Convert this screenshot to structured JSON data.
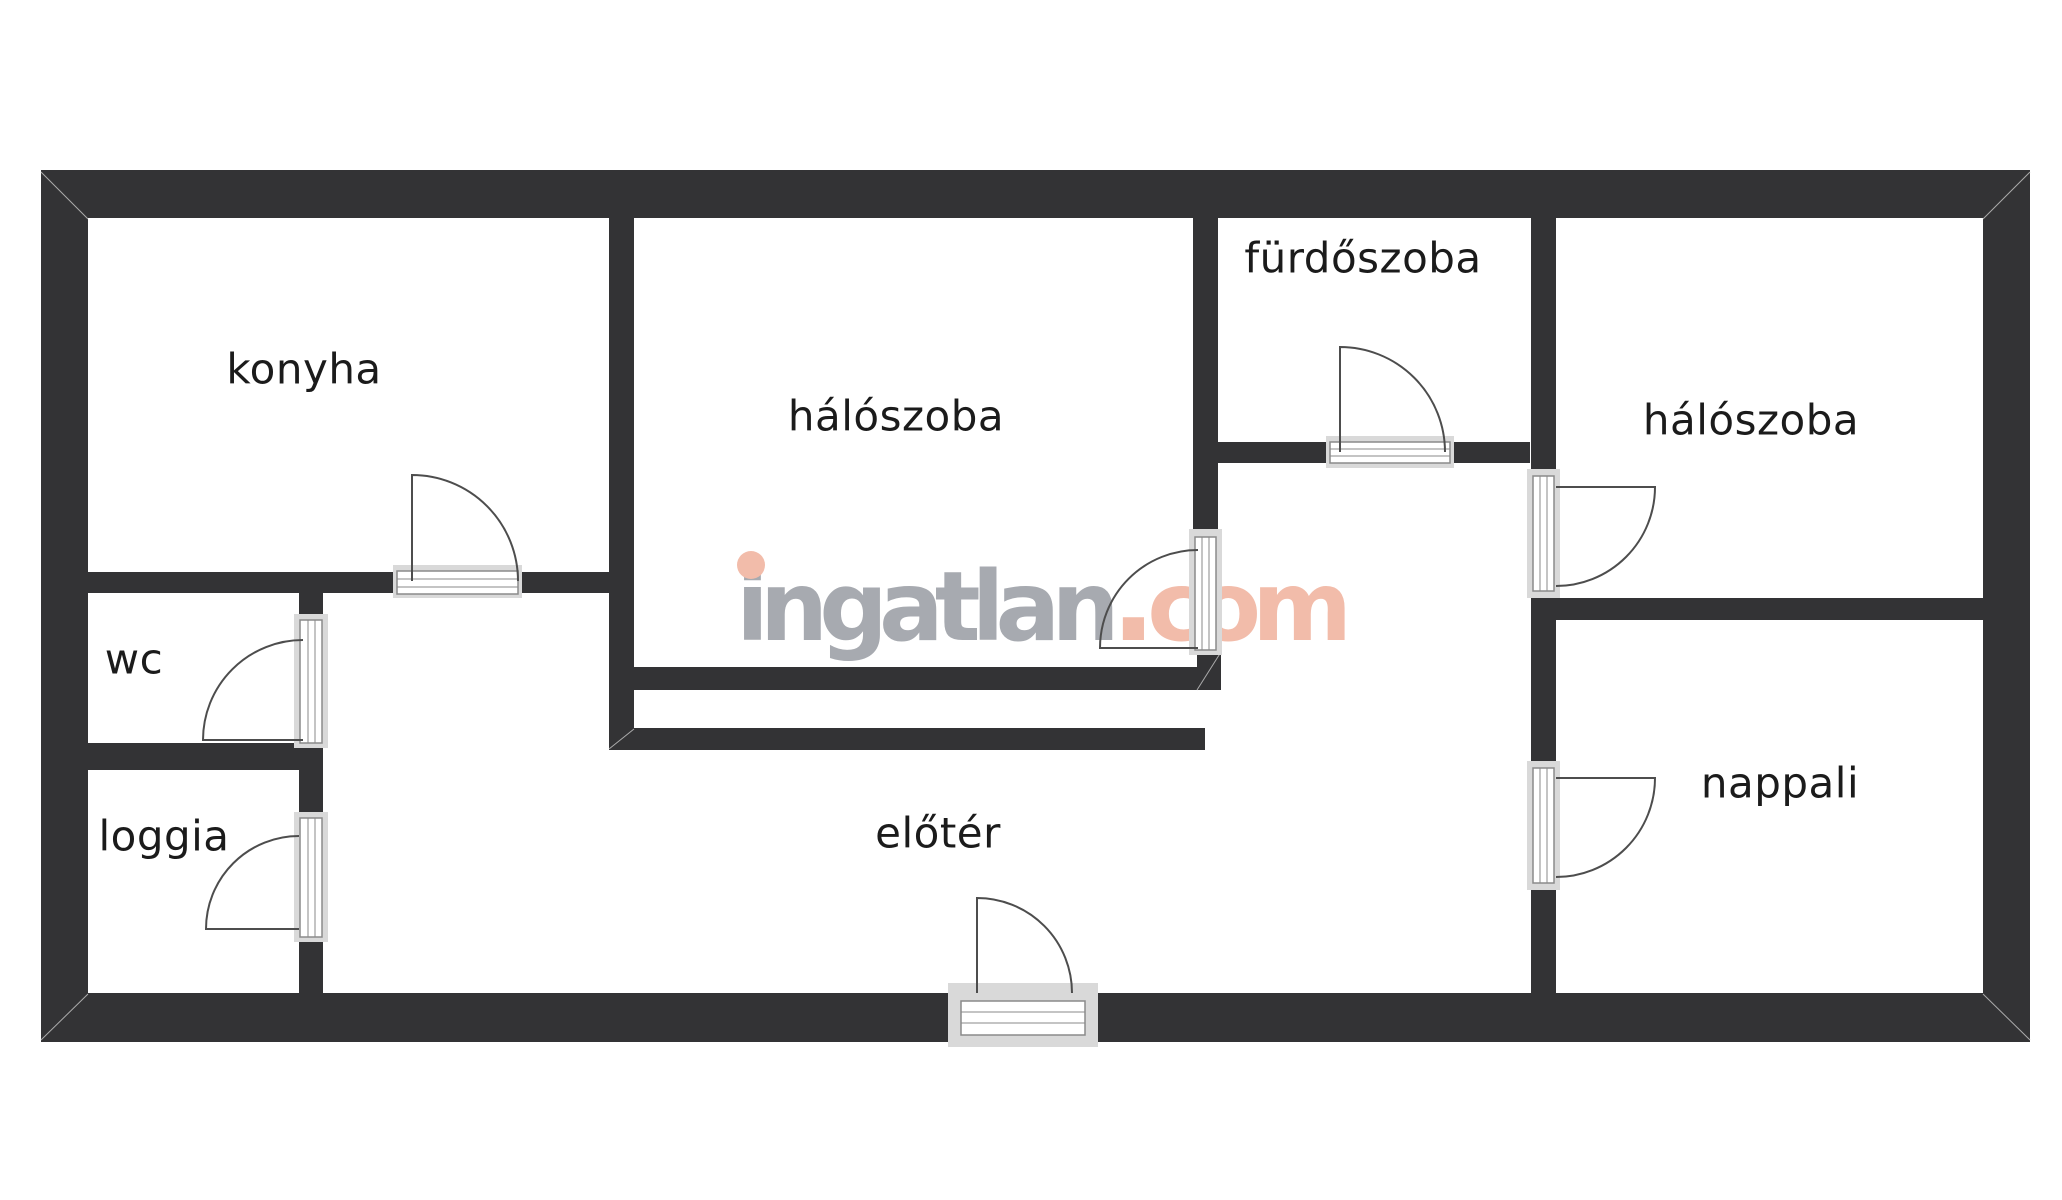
{
  "watermark": {
    "brand": "ingatlan",
    "dot": ".",
    "tld": "com",
    "brand_color": "#a7aab0",
    "accent_color": "#f2bcaa"
  },
  "rooms": [
    {
      "name": "konyha"
    },
    {
      "name": "hálószoba"
    },
    {
      "name": "fürdőszoba"
    },
    {
      "name": "hálószoba"
    },
    {
      "name": "wc"
    },
    {
      "name": "loggia"
    },
    {
      "name": "előtér"
    },
    {
      "name": "nappali"
    }
  ],
  "colors": {
    "wall": "#333335",
    "door_line": "#4d4d4d",
    "label": "#1b1b1b",
    "background": "#ffffff",
    "wm_gray": "#a7aab0",
    "wm_accent": "#f2bcaa"
  }
}
